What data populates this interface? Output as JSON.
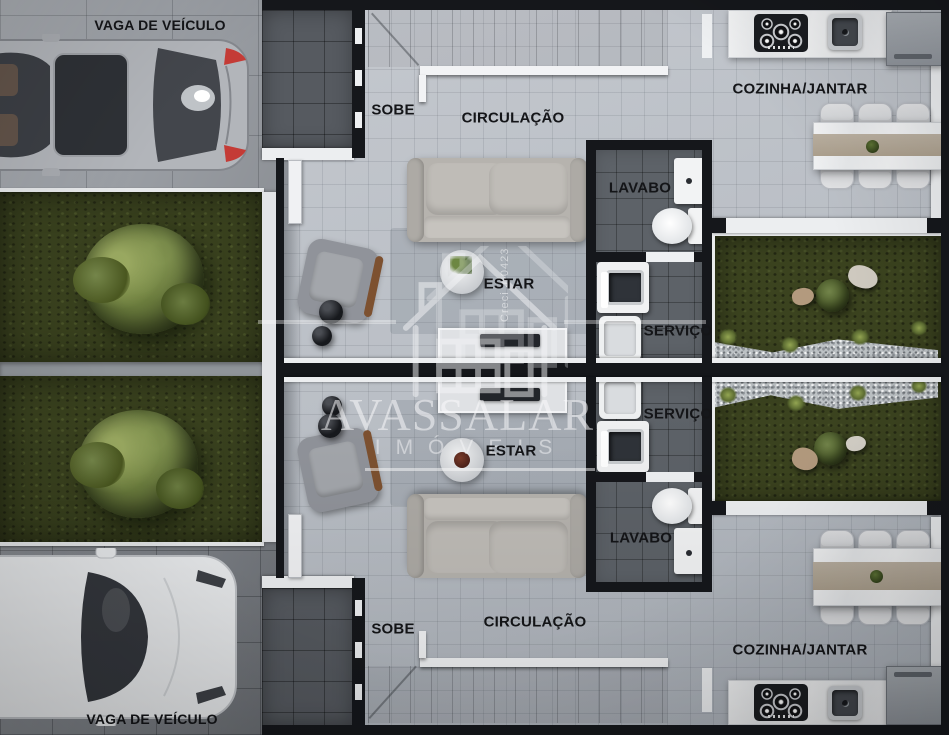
{
  "page": {
    "type": "architectural-floor-plan",
    "view": "top-down render",
    "units": 2
  },
  "outdoor": {
    "parking_top": "VAGA DE VEÍCULO",
    "parking_bottom": "VAGA DE VEÍCULO"
  },
  "rooms": {
    "unit_top": {
      "stairs": "SOBE",
      "circulation": "CIRCULAÇÃO",
      "kitchen_dining": "COZINHA/JANTAR",
      "powder_room": "LAVABO",
      "living": "ESTAR",
      "service": "SERVIÇO"
    },
    "unit_bottom": {
      "stairs": "SOBE",
      "circulation": "CIRCULAÇÃO",
      "kitchen_dining": "COZINHA/JANTAR",
      "powder_room": "LAVABO",
      "living": "ESTAR",
      "service": "SERVIÇO"
    }
  },
  "watermark": {
    "brand": "AVASSALAR",
    "subtitle": "IMÓVEIS",
    "license": "Creci J-0423"
  },
  "colors": {
    "wall": "#15171b",
    "floor_tile": "#b9bec5",
    "wet_floor": "#5d6268",
    "porch_tile": "#565a60",
    "grass": "#39411e",
    "garden_grass": "#3b431f",
    "accent_white": "#eceef0",
    "label_text": "#141518",
    "runner_beige": "#b3a996"
  }
}
